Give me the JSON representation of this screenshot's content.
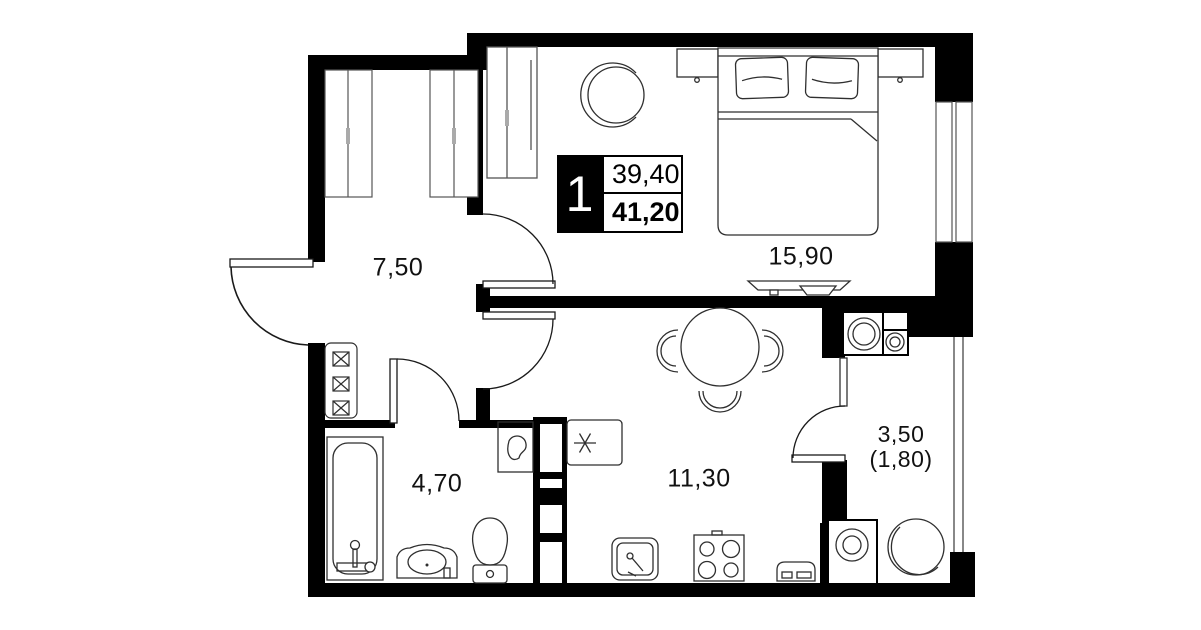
{
  "unit": {
    "number": "1",
    "living_area": "39,40",
    "total_area": "41,20"
  },
  "rooms": {
    "hallway": {
      "area": "7,50"
    },
    "bedroom": {
      "area": "15,90"
    },
    "bathroom": {
      "area": "4,70"
    },
    "kitchen_living": {
      "area": "11,30"
    },
    "balcony": {
      "area": "3,50",
      "area_with_coefficient": "(1,80)"
    }
  },
  "colors": {
    "background": "#ffffff",
    "walls": "#000000",
    "furniture_line": "#2f2f2f"
  }
}
